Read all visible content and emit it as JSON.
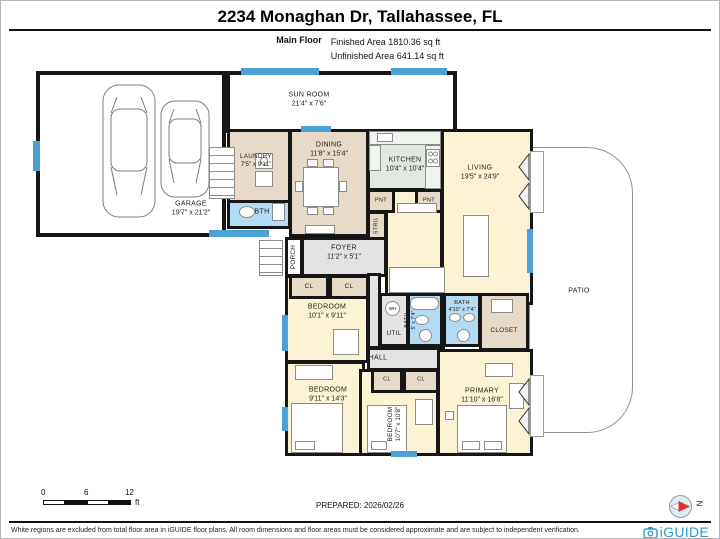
{
  "header": {
    "title": "2234 Monaghan Dr, Tallahassee, FL",
    "floor_label": "Main Floor",
    "finished": "Finished Area 1810.36 sq ft",
    "unfinished": "Unfinished Area 641.14 sq ft"
  },
  "rooms": {
    "garage": {
      "name": "GARAGE",
      "dims": "19'7\" x 21'2\""
    },
    "sunroom": {
      "name": "SUN ROOM",
      "dims": "21'4\" x 7'6\""
    },
    "laundry": {
      "name": "LAUNDRY",
      "dims": "7'5\" x 9'11\""
    },
    "bth": {
      "name": "BTH"
    },
    "dining": {
      "name": "DINING",
      "dims": "11'8\" x 15'4\""
    },
    "kitchen": {
      "name": "KITCHEN",
      "dims": "10'4\" x 10'4\""
    },
    "living": {
      "name": "LIVING",
      "dims": "19'5\" x 24'9\""
    },
    "pnt": {
      "name": "PNT"
    },
    "strg": {
      "name": "STRG"
    },
    "porch": {
      "name": "PORCH"
    },
    "foyer": {
      "name": "FOYER",
      "dims": "11'2\" x 5'1\""
    },
    "cl": {
      "name": "CL"
    },
    "bedroom1": {
      "name": "BEDROOM",
      "dims": "10'1\" x 9'11\""
    },
    "util": {
      "name": "UTIL"
    },
    "wh": {
      "name": "WH"
    },
    "bath1": {
      "name": "BATH",
      "dims": "5' x 7'4\""
    },
    "bath2": {
      "name": "BATH",
      "dims": "4'10\" x 7'4\""
    },
    "closet": {
      "name": "CLOSET"
    },
    "hall": {
      "name": "HALL"
    },
    "bedroom2": {
      "name": "BEDROOM",
      "dims": "9'11\" x 14'3\""
    },
    "bedroom3": {
      "name": "BEDROOM",
      "dims": "10'7\" x 10'8\""
    },
    "primary": {
      "name": "PRIMARY",
      "dims": "11'10\" x 16'8\""
    },
    "patio": {
      "name": "PATIO"
    }
  },
  "footer": {
    "scale_ticks": [
      "0",
      "6",
      "12"
    ],
    "scale_unit": "ft",
    "prepared": "PREPARED: 2026/02/26",
    "compass_letter": "N"
  },
  "disclaimer": "White regions are excluded from total floor area in iGUIDE floor plans. All room dimensions and floor areas must be considered approximate and are subject to independent verification.",
  "brand": {
    "name": "iGUIDE"
  },
  "colors": {
    "wall": "#161616",
    "window": "#4ba1d7",
    "bath": "#b3dcf2",
    "tan": "#e8dac9",
    "yellow": "#fbf3d4",
    "kitchen": "#e0eae2",
    "gray": "#e3e3e3",
    "logo": "#2d9dc8"
  }
}
